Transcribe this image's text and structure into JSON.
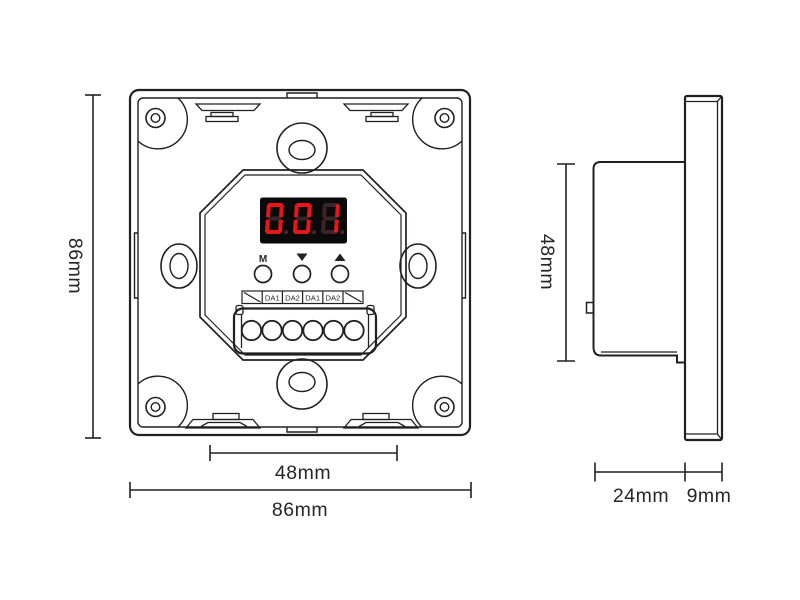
{
  "title": "panel-dimension-drawing",
  "colors": {
    "line": "#231f20",
    "text": "#262626",
    "background": "#ffffff"
  },
  "front_view": {
    "display": {
      "value": "001",
      "bright_color": "#e81616",
      "ghost_color": "#3a2427",
      "dot_color": "#522527",
      "background": "#0b0a0a"
    },
    "buttons": {
      "mode_label": "M",
      "down_icon": "triangle-down",
      "up_icon": "triangle-up"
    },
    "terminal_strip": {
      "labels": [
        "DA1",
        "DA2",
        "DA1",
        "DA2"
      ]
    },
    "terminal_count": 6
  },
  "dimensions": {
    "front_height": "86mm",
    "front_width": "86mm",
    "front_terminal_width": "48mm",
    "side_height": "48mm",
    "box_depth": "24mm",
    "plate_depth": "9mm"
  }
}
